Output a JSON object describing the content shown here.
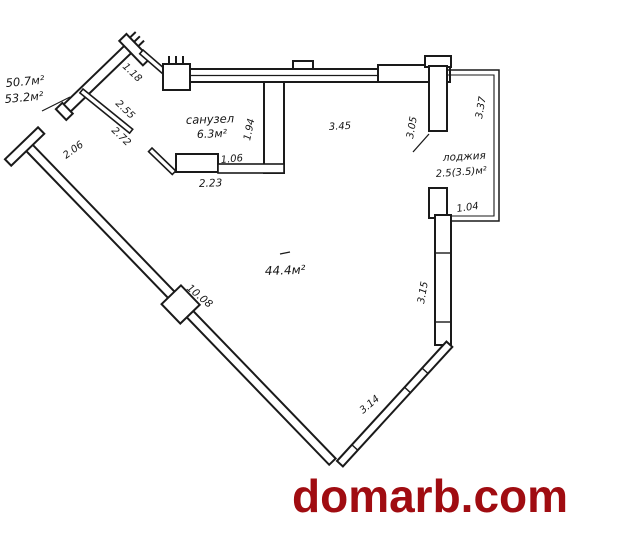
{
  "plan": {
    "ink_color": "#1a1a1a",
    "area_labels": {
      "total_1": "50.7м²",
      "total_2": "53.2м²",
      "bathroom_name": "санузел",
      "bathroom_area": "6.3м²",
      "room_area": "44.4м²",
      "loggia_name": "лоджия",
      "loggia_area": "2.5(3.5)м²"
    },
    "dimensions": {
      "entry_opening": "1.18",
      "hall_upper": "2.55",
      "hall_lower": "2.72",
      "entry_wall": "2.06",
      "bath_depth": "1.94",
      "bath_door": "1.06",
      "bath_width": "2.23",
      "top_wall": "3.45",
      "loggia_partition": "3.05",
      "loggia_side": "3.37",
      "loggia_bottom": "1.04",
      "left_wall": "10.08",
      "right_window": "3.15",
      "bottom_window": "3.14"
    }
  },
  "watermark": {
    "text": "domarb.com",
    "color": "#A00C11"
  }
}
